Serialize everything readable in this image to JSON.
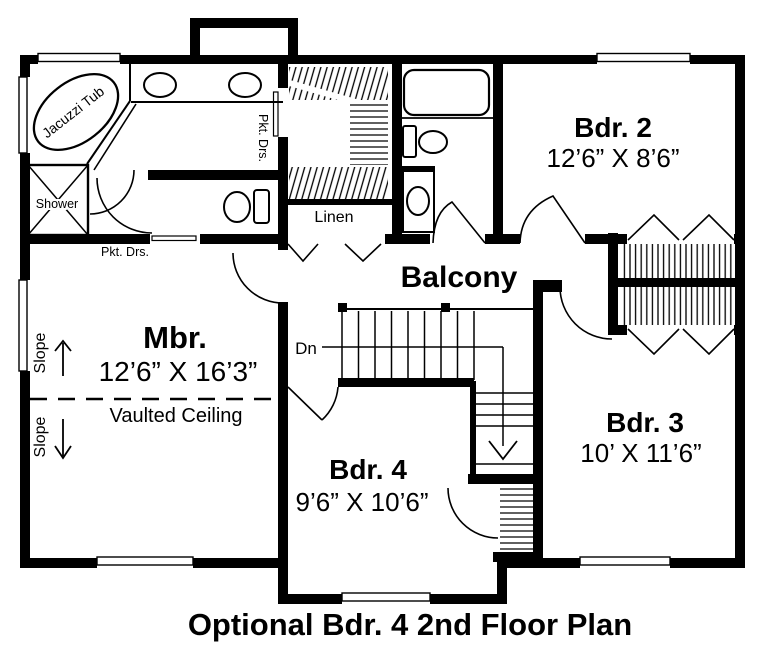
{
  "title": "Optional Bdr. 4 2nd Floor Plan",
  "colors": {
    "wall": "#000000",
    "background": "#ffffff",
    "line": "#000000"
  },
  "rooms": {
    "mbr": {
      "name": "Mbr.",
      "dims": "12’6” X 16’3”"
    },
    "bdr2": {
      "name": "Bdr. 2",
      "dims": "12’6” X 8’6”"
    },
    "bdr3": {
      "name": "Bdr. 3",
      "dims": "10’ X 11’6”"
    },
    "bdr4": {
      "name": "Bdr. 4",
      "dims": "9’6” X 10’6”"
    },
    "balcony": {
      "name": "Balcony"
    },
    "linen": {
      "name": "Linen"
    }
  },
  "fixtures": {
    "jacuzzi": "Jacuzzi Tub",
    "shower": "Shower"
  },
  "annotations": {
    "pocket_doors_closet": "Pkt. Drs.",
    "pocket_doors_hall": "Pkt. Drs.",
    "vaulted_ceiling": "Vaulted Ceiling",
    "slope_upper": "Slope",
    "slope_lower": "Slope",
    "stairs_down": "Dn"
  }
}
